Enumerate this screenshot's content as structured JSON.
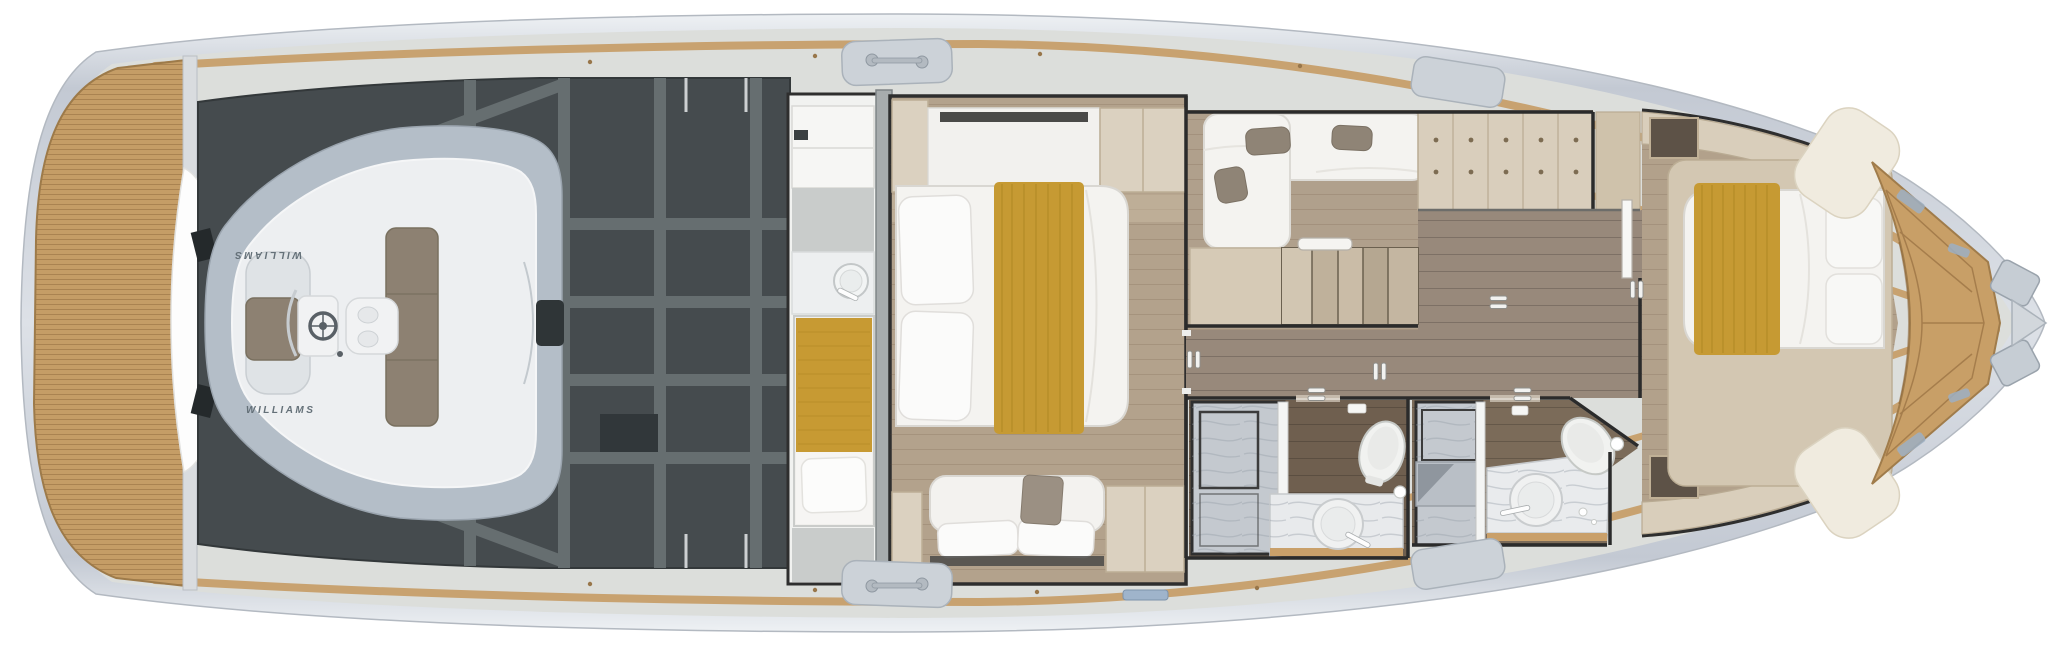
{
  "canvas": {
    "width": 2048,
    "height": 646,
    "background": "#ffffff"
  },
  "scene": {
    "type": "yacht-deck-plan",
    "view": "top-down floor plan rendering",
    "deck": "lower deck / accommodation plan with aft tender garage"
  },
  "branding": {
    "transom_logo_primary": "solaris",
    "transom_logo_secondary": "power.",
    "tender_logo": "WILLIAMS"
  },
  "palette": {
    "hull_silver": "#c9ced6",
    "deck_gray": "#dcdedb",
    "caprail_tan": "#c8a270",
    "teak": "#c59d66",
    "engine_room": "#454b4e",
    "engine_frame": "#6a7274",
    "wall_dark": "#2e2e2e",
    "wood_floor": "#b3a28c",
    "corridor_floor": "#98897b",
    "bathroom_floor": "#6f5f4f",
    "cabinet_wood": "#d9cebc",
    "mattress_white": "#f4f3f0",
    "blanket_gold": "#c69a33",
    "pillow_taupe": "#8f8476",
    "marble": "#c4c9cf",
    "fixture_white": "#f1f2f0",
    "tender_tube": "#b4bec8",
    "tender_cushion": "#8d8172"
  },
  "rooms": [
    {
      "id": "swim-platform",
      "label": "Teak swim platform"
    },
    {
      "id": "tender-garage",
      "label": "Tender garage with Williams jet RIB"
    },
    {
      "id": "engine-room",
      "label": "Engine room"
    },
    {
      "id": "crew-cabin",
      "label": "Crew cabin with single berth and washbasin"
    },
    {
      "id": "master-cabin",
      "label": "Master cabin with double bed and sofa"
    },
    {
      "id": "twin-cabin",
      "label": "Guest cabin with L-shaped twin berths"
    },
    {
      "id": "staircase",
      "label": "Companionway stairs"
    },
    {
      "id": "corridor",
      "label": "Lower deck corridor"
    },
    {
      "id": "master-bathroom",
      "label": "Master bathroom with shower, WC and washbasin"
    },
    {
      "id": "guest-bathroom",
      "label": "Guest bathroom with shower, WC and washbasin"
    },
    {
      "id": "vip-cabin",
      "label": "Forward VIP cabin with double bed"
    },
    {
      "id": "bow-deck",
      "label": "Teak bow deck with anchor fitting"
    }
  ]
}
